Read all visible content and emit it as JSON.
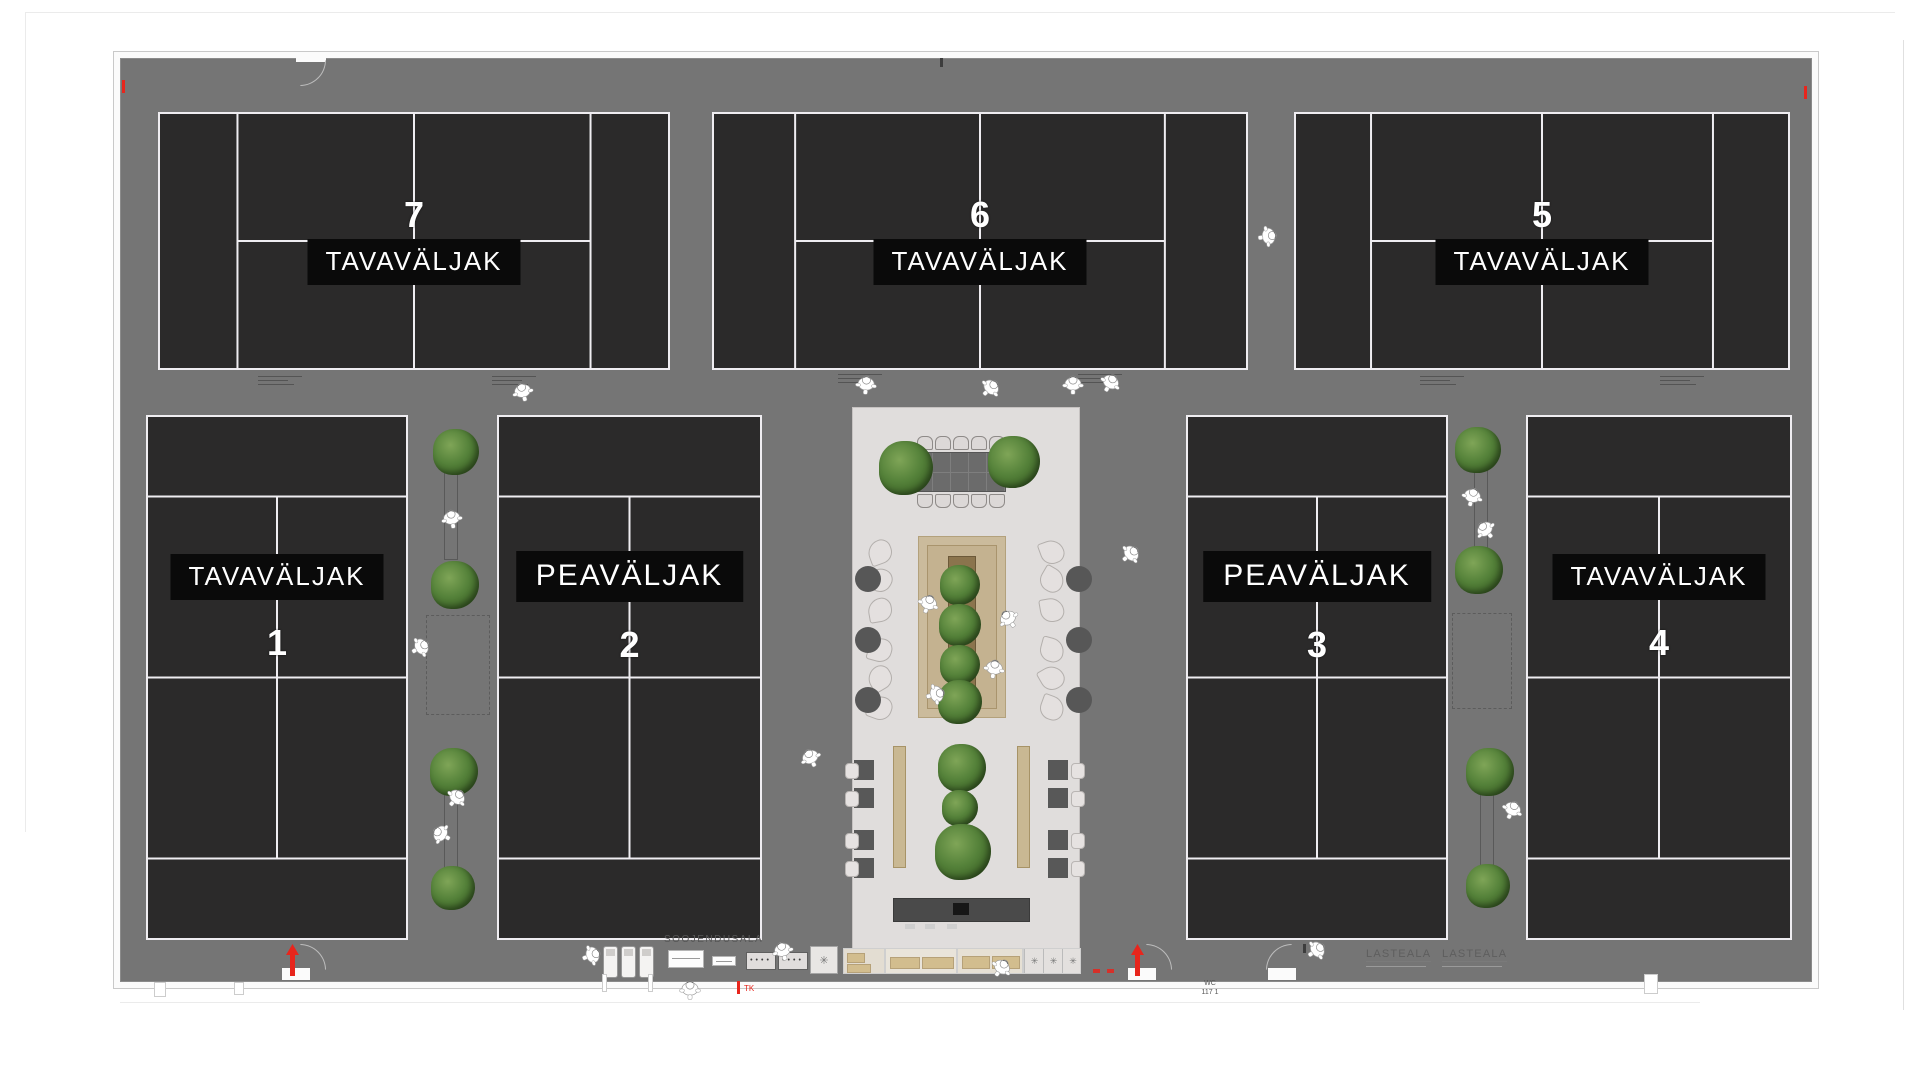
{
  "colors": {
    "floor": "#757575",
    "court": "#2b2a2a",
    "court_line": "#efedf1",
    "label_bg": "#0a0a0a",
    "label_fg": "#ffffff",
    "lobby": "#e0dddc",
    "deck": "#cbbb9c",
    "planter": "#8b744d",
    "tree": "#55823a",
    "accent_red": "#e8251c",
    "wall": "#fbfbfb"
  },
  "plan": {
    "texts": {
      "warmup_area": "SOOJENDUSALA",
      "kids_area_1": "LASTEALA",
      "kids_area_2": "LASTEALA",
      "wc_label": "WC",
      "wc_number": "117 1",
      "exit_label": "TK"
    },
    "courts": [
      {
        "id": "court-7",
        "number": "7",
        "label": "TAVAVÄLJAK",
        "type": "standard",
        "orientation": "landscape",
        "x": 158,
        "y": 112,
        "w": 512,
        "h": 258,
        "number_pos": "above",
        "label_offset": 84
      },
      {
        "id": "court-6",
        "number": "6",
        "label": "TAVAVÄLJAK",
        "type": "standard",
        "orientation": "landscape",
        "x": 712,
        "y": 112,
        "w": 536,
        "h": 258,
        "number_pos": "above",
        "label_offset": 84
      },
      {
        "id": "court-5",
        "number": "5",
        "label": "TAVAVÄLJAK",
        "type": "standard",
        "orientation": "landscape",
        "x": 1294,
        "y": 112,
        "w": 496,
        "h": 258,
        "number_pos": "above",
        "label_offset": 84
      },
      {
        "id": "court-1",
        "number": "1",
        "label": "TAVAVÄLJAK",
        "type": "standard",
        "orientation": "portrait",
        "x": 146,
        "y": 415,
        "w": 262,
        "h": 525,
        "number_pos": "below",
        "label_offset": 139
      },
      {
        "id": "court-2",
        "number": "2",
        "label": "PEAVÄLJAK",
        "type": "main",
        "orientation": "portrait",
        "x": 497,
        "y": 415,
        "w": 265,
        "h": 525,
        "number_pos": "below",
        "label_offset": 136
      },
      {
        "id": "court-3",
        "number": "3",
        "label": "PEAVÄLJAK",
        "type": "main",
        "orientation": "portrait",
        "x": 1186,
        "y": 415,
        "w": 262,
        "h": 525,
        "number_pos": "below",
        "label_offset": 136
      },
      {
        "id": "court-4",
        "number": "4",
        "label": "TAVAVÄLJAK",
        "type": "standard",
        "orientation": "portrait",
        "x": 1526,
        "y": 415,
        "w": 266,
        "h": 525,
        "number_pos": "below",
        "label_offset": 139
      }
    ],
    "trees": [
      [
        456,
        452,
        46
      ],
      [
        455,
        585,
        48
      ],
      [
        454,
        772,
        48
      ],
      [
        453,
        888,
        44
      ],
      [
        1478,
        450,
        46
      ],
      [
        1479,
        570,
        48
      ],
      [
        1490,
        772,
        48
      ],
      [
        1488,
        886,
        44
      ],
      [
        906,
        468,
        54
      ],
      [
        1014,
        462,
        52
      ],
      [
        960,
        585,
        40
      ],
      [
        960,
        625,
        42
      ],
      [
        960,
        665,
        40
      ],
      [
        960,
        702,
        44
      ],
      [
        962,
        768,
        48
      ],
      [
        960,
        808,
        36
      ],
      [
        963,
        852,
        56
      ]
    ],
    "people": [
      [
        523,
        390,
        -15
      ],
      [
        866,
        383,
        5
      ],
      [
        990,
        386,
        45
      ],
      [
        1073,
        383,
        0
      ],
      [
        1110,
        381,
        30
      ],
      [
        1267,
        234,
        80
      ],
      [
        452,
        517,
        -10
      ],
      [
        420,
        645,
        60
      ],
      [
        1472,
        495,
        15
      ],
      [
        1486,
        528,
        -40
      ],
      [
        928,
        602,
        20
      ],
      [
        1009,
        617,
        -35
      ],
      [
        994,
        667,
        10
      ],
      [
        935,
        692,
        75
      ],
      [
        1130,
        552,
        50
      ],
      [
        811,
        756,
        -25
      ],
      [
        456,
        796,
        40
      ],
      [
        442,
        832,
        -60
      ],
      [
        1512,
        808,
        25
      ],
      [
        591,
        953,
        70
      ],
      [
        783,
        949,
        -15
      ],
      [
        1001,
        966,
        35
      ],
      [
        1316,
        948,
        55
      ],
      [
        690,
        988,
        0
      ]
    ],
    "furniture": {
      "meeting_chairs_x": [
        917,
        935,
        953,
        971,
        989
      ],
      "meeting_chairs_top_y": 436,
      "meeting_chairs_bottom_y": 494,
      "loungers_left_x": 868,
      "loungers_right_x": 1040,
      "loungers_y": [
        540,
        568,
        598,
        638,
        666,
        696
      ],
      "lounger_rot": [
        -20,
        30,
        -10,
        15,
        -30,
        20
      ],
      "side_tables": [
        [
          855,
          566
        ],
        [
          855,
          627
        ],
        [
          855,
          687
        ],
        [
          1066,
          566
        ],
        [
          1066,
          627
        ],
        [
          1066,
          687
        ]
      ],
      "wood_strips": [
        [
          893,
          746,
          11,
          120
        ],
        [
          1017,
          746,
          11,
          120
        ]
      ],
      "dine_tables": [
        [
          854,
          760
        ],
        [
          854,
          788
        ],
        [
          854,
          830
        ],
        [
          854,
          858
        ],
        [
          1048,
          760
        ],
        [
          1048,
          788
        ],
        [
          1048,
          830
        ],
        [
          1048,
          858
        ]
      ],
      "benches": [
        [
          444,
          462,
          12,
          96
        ],
        [
          444,
          792,
          12,
          96
        ],
        [
          1474,
          462,
          12,
          96
        ],
        [
          1480,
          790,
          12,
          96
        ]
      ],
      "dashed_zones": [
        [
          426,
          615,
          62,
          98
        ],
        [
          1452,
          613,
          58,
          94
        ]
      ],
      "treadmills": [
        [
          603,
          946
        ],
        [
          621,
          946
        ],
        [
          639,
          946
        ]
      ],
      "stools": [
        [
          905,
          924
        ],
        [
          925,
          924
        ],
        [
          947,
          924
        ]
      ],
      "notes": [
        [
          258,
          376
        ],
        [
          492,
          376
        ],
        [
          838,
          374
        ],
        [
          1078,
          374
        ],
        [
          1420,
          376
        ],
        [
          1660,
          376
        ]
      ]
    }
  }
}
